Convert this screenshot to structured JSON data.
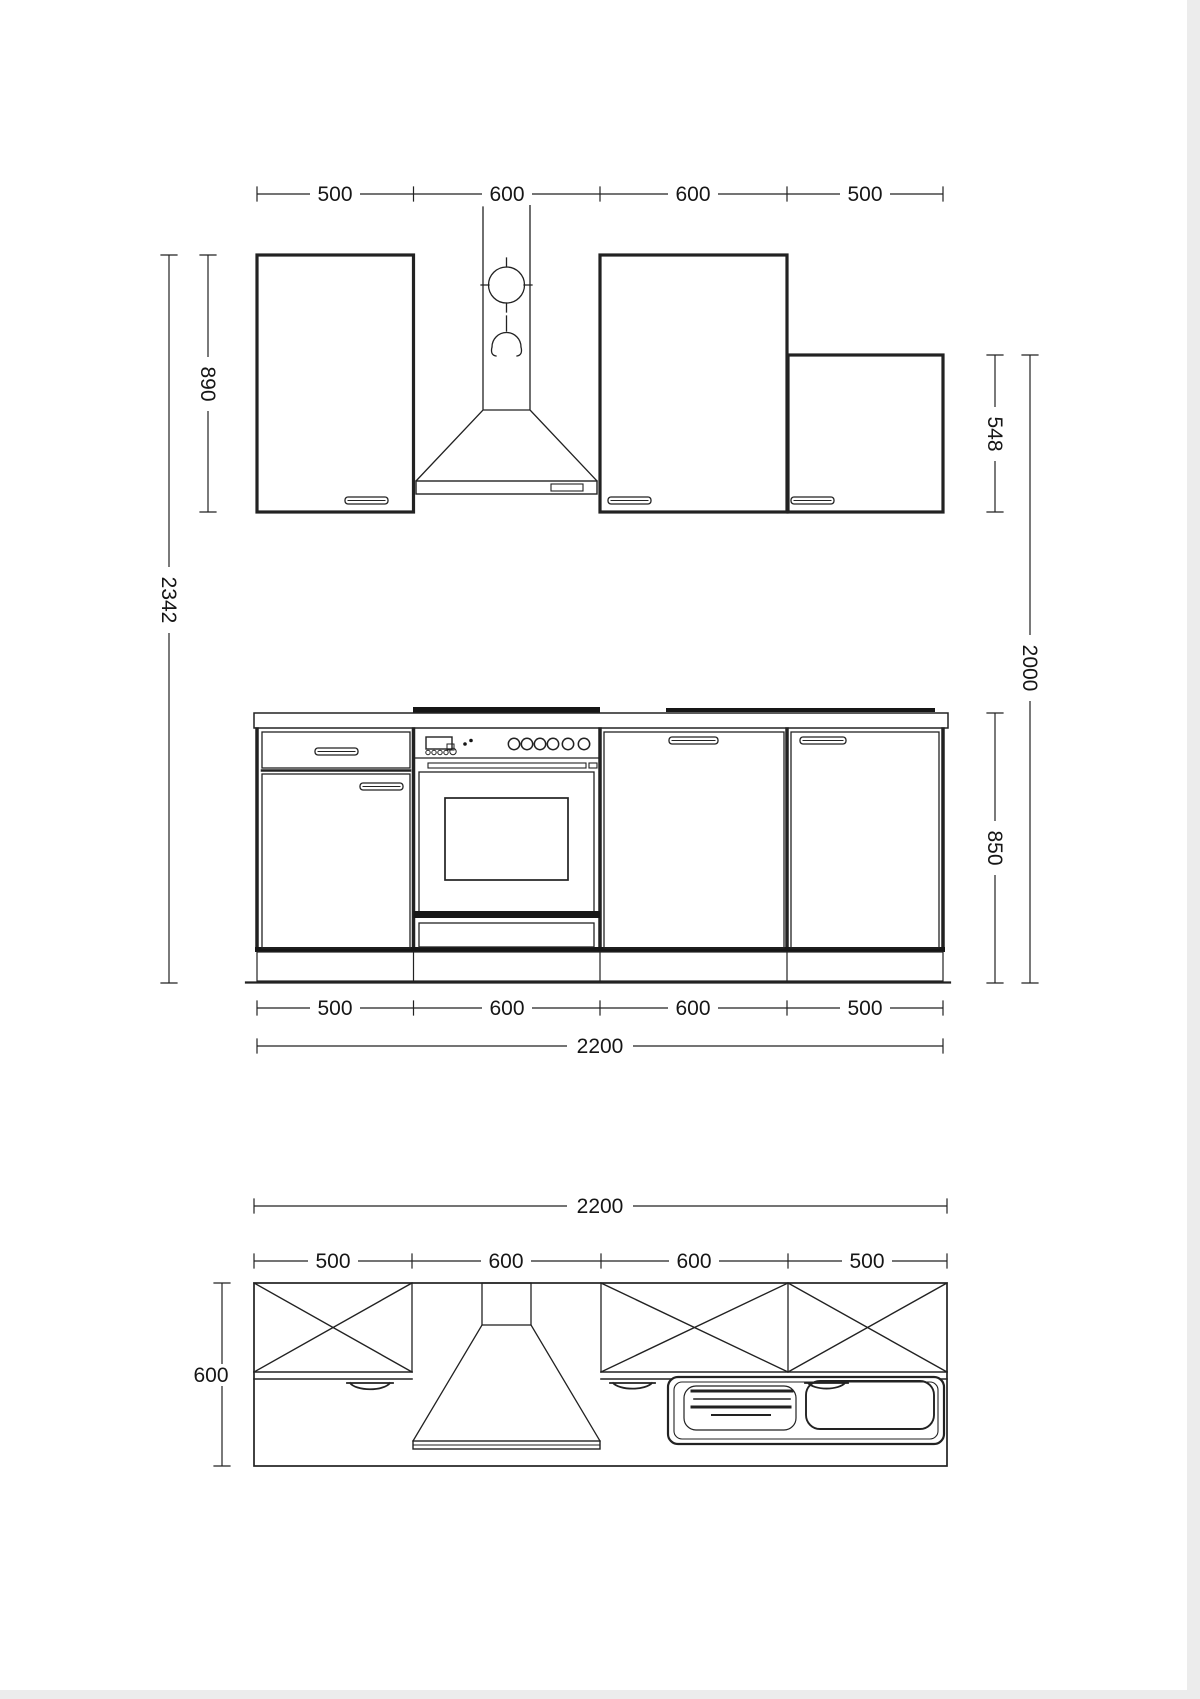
{
  "dimensions": {
    "upper": {
      "segments": [
        "500",
        "600",
        "600",
        "500"
      ],
      "wall_cabinet_height": "890",
      "total_height": "2342",
      "short_cabinet_height": "548",
      "upper_right_height": "2000"
    },
    "base": {
      "segments": [
        "500",
        "600",
        "600",
        "500"
      ],
      "run_width": "2200",
      "height": "850"
    },
    "plan": {
      "run_width": "2200",
      "segments": [
        "500",
        "600",
        "600",
        "500"
      ],
      "depth": "600"
    }
  }
}
